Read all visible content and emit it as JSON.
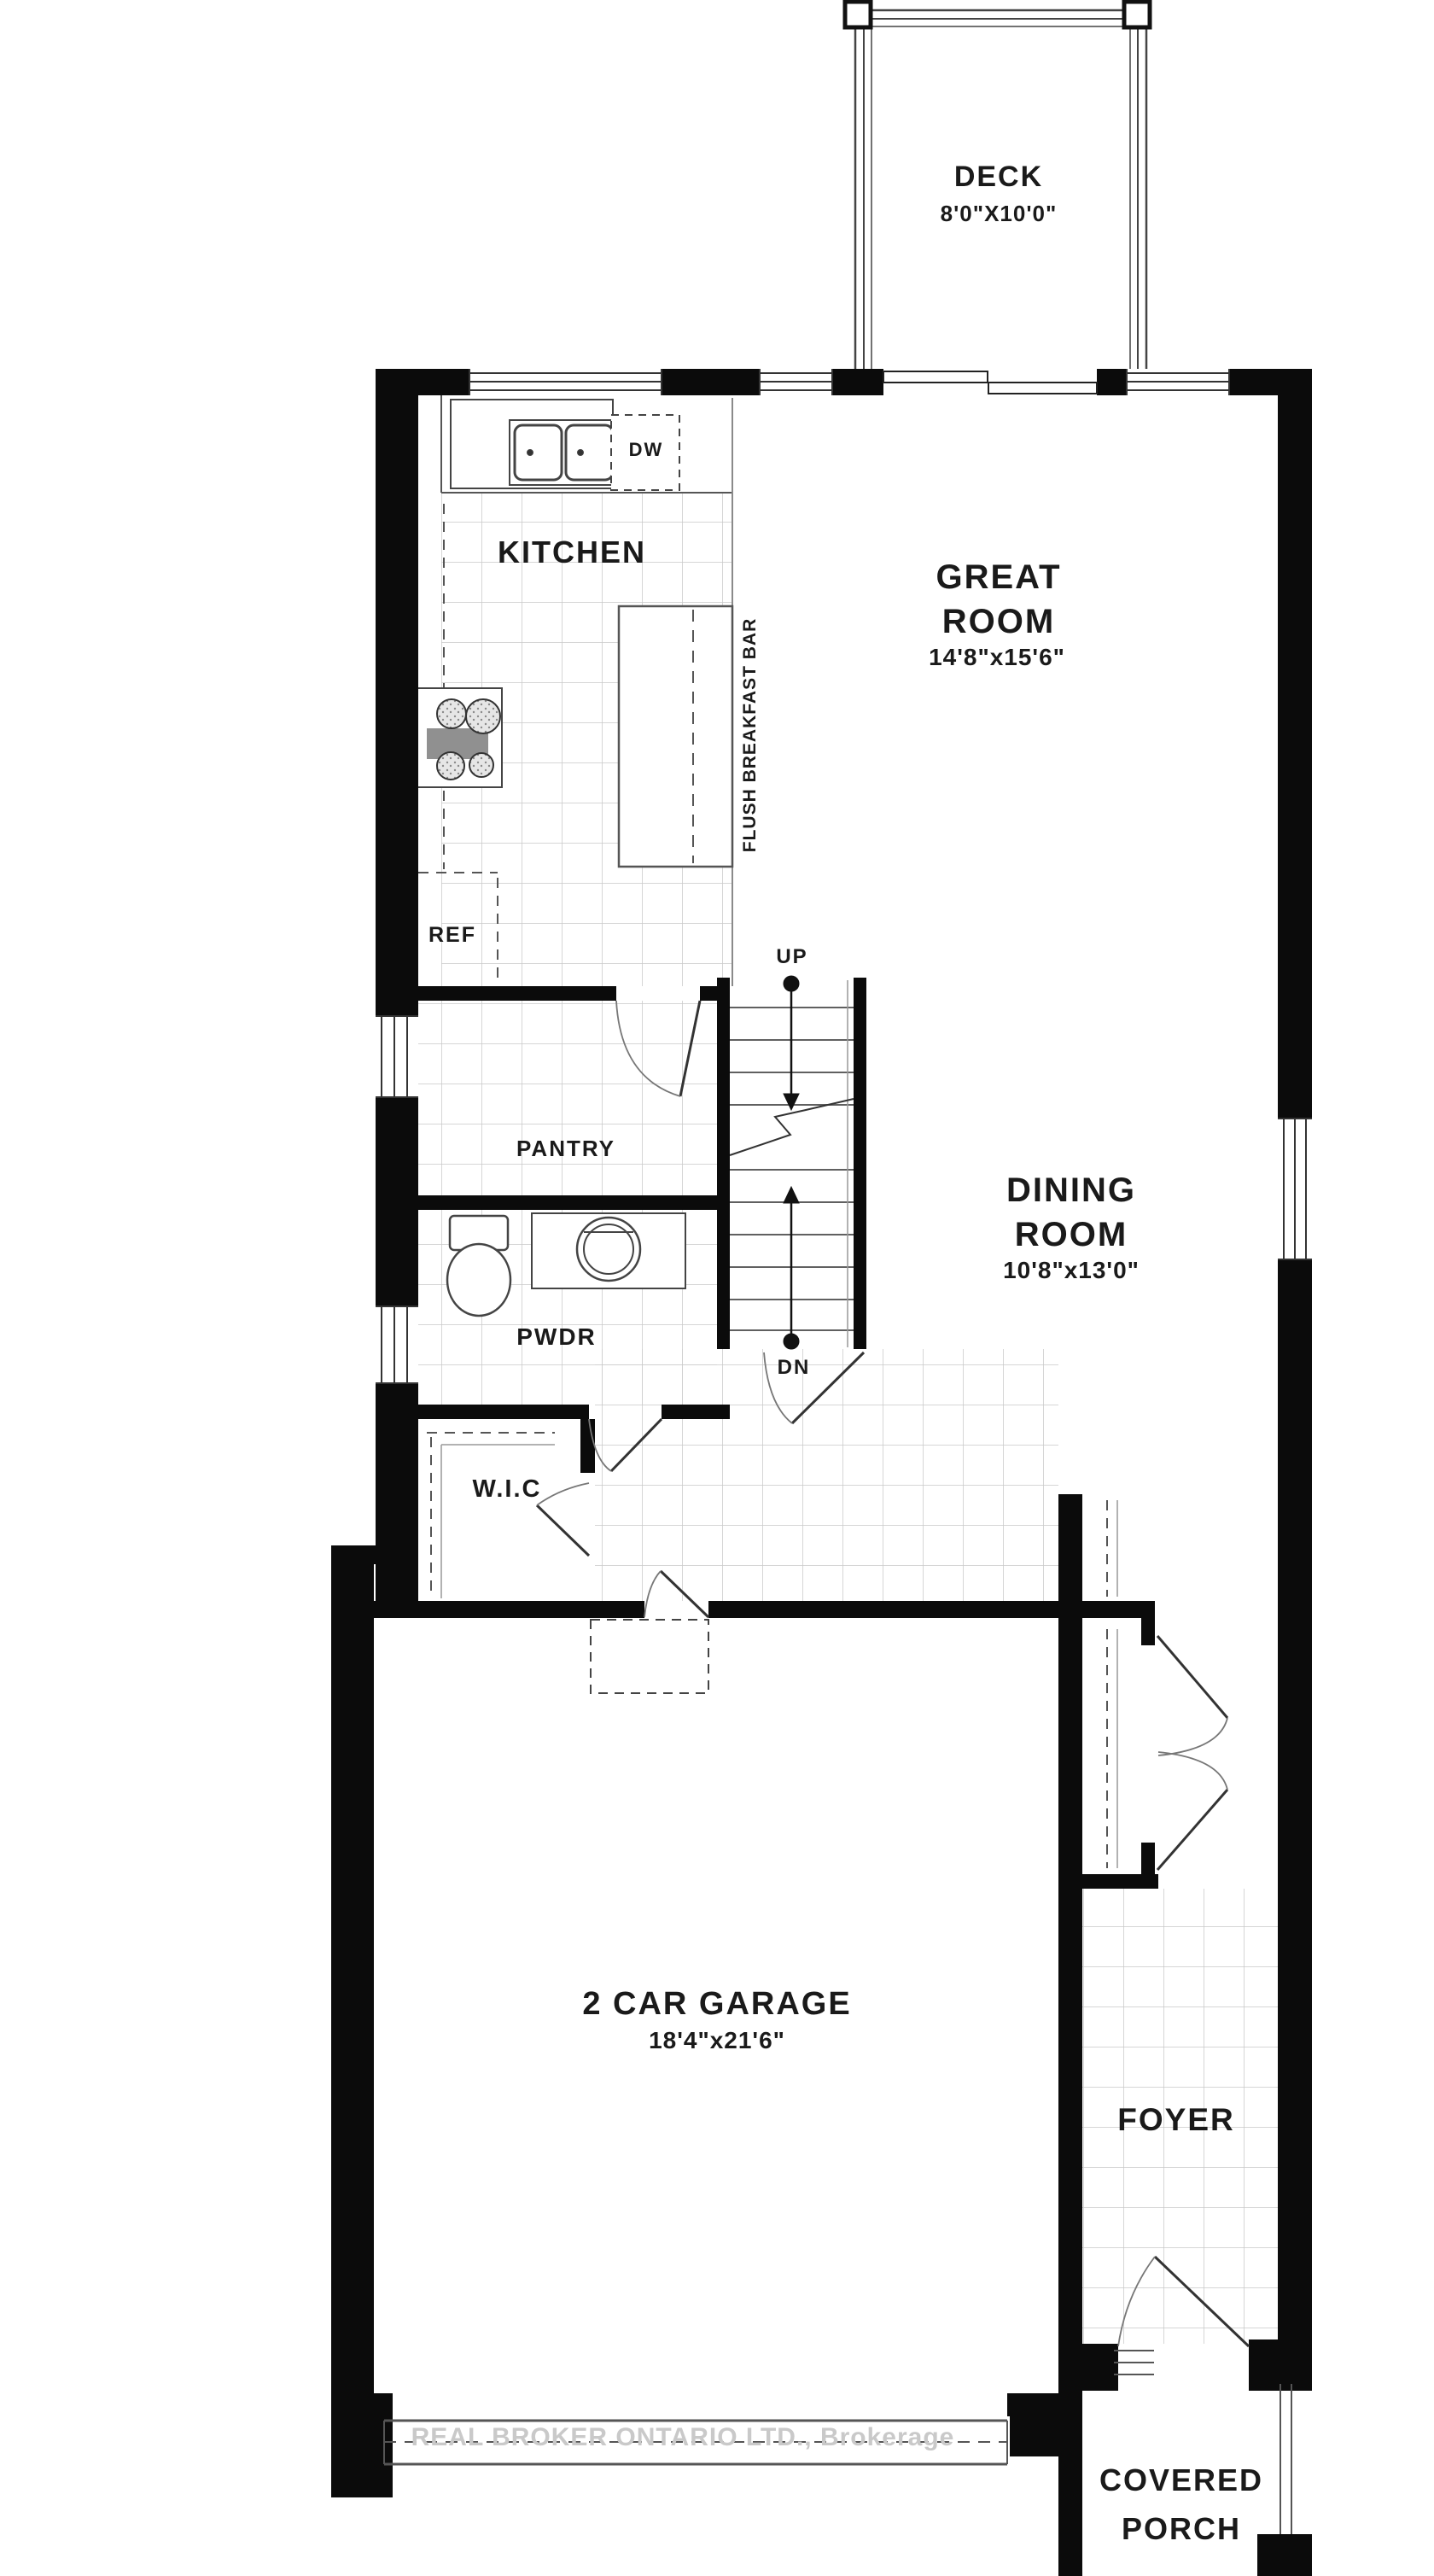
{
  "plan": {
    "rooms": {
      "deck": {
        "name": "DECK",
        "dims": "8'0\"X10'0\""
      },
      "kitchen": {
        "name": "KITCHEN"
      },
      "great_room": {
        "name": "GREAT\nROOM",
        "dims": "14'8\"x15'6\""
      },
      "dining_room": {
        "name": "DINING\nROOM",
        "dims": "10'8\"x13'0\""
      },
      "pantry": {
        "name": "PANTRY"
      },
      "powder_room": {
        "name": "PWDR"
      },
      "walk_in_closet": {
        "name": "W.I.C"
      },
      "garage": {
        "name": "2 CAR GARAGE",
        "dims": "18'4\"x21'6\""
      },
      "foyer": {
        "name": "FOYER"
      },
      "covered_porch": {
        "name": "COVERED\nPORCH"
      }
    },
    "annotations": {
      "up": "UP",
      "down": "DN",
      "fridge": "REF",
      "dishwasher": "DW",
      "breakfast_bar": "FLUSH BREAKFAST BAR"
    },
    "watermark": "REAL BROKER ONTARIO LTD., Brokerage",
    "colors": {
      "wall": "#0b0b0b",
      "tile_line": "#c9c9c9",
      "fixture_line": "#444444",
      "watermark_text": "#c9c9c9"
    }
  }
}
